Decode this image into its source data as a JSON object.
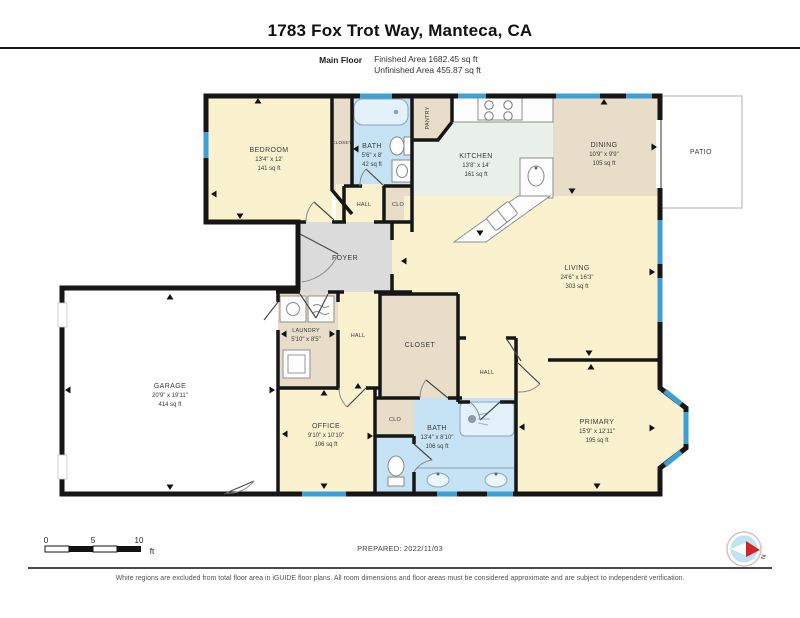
{
  "header": {
    "title": "1783 Fox Trot Way, Manteca, CA",
    "floor_label": "Main Floor",
    "finished_area": "Finished Area 1682.45 sq ft",
    "unfinished_area": "Unfinished Area 455.87 sq ft"
  },
  "rooms": {
    "bedroom": {
      "name": "BEDROOM",
      "dims": "13'4\" x 12'",
      "area": "141 sq ft"
    },
    "closet_top": {
      "name": "CLOSET"
    },
    "bath_top": {
      "name": "BATH",
      "dims": "5'6\" x 8'",
      "area": "42 sq ft"
    },
    "hall_top": {
      "name": "HALL"
    },
    "clo_top": {
      "name": "CLO"
    },
    "pantry": {
      "name": "PANTRY"
    },
    "kitchen": {
      "name": "KITCHEN",
      "dims": "13'8\" x 14'",
      "area": "161 sq ft"
    },
    "dining": {
      "name": "DINING",
      "dims": "10'9\" x 9'9\"",
      "area": "105 sq ft"
    },
    "patio": {
      "name": "PATIO"
    },
    "living": {
      "name": "LIVING",
      "dims": "24'6\" x 16'3\"",
      "area": "303 sq ft"
    },
    "foyer": {
      "name": "FOYER"
    },
    "laundry": {
      "name": "LAUNDRY",
      "dims": "5'10\" x 8'5\""
    },
    "hall_mid": {
      "name": "HALL"
    },
    "closet_mid": {
      "name": "CLOSET"
    },
    "hall_right": {
      "name": "HALL"
    },
    "garage": {
      "name": "GARAGE",
      "dims": "20'9\" x 19'11\"",
      "area": "414 sq ft"
    },
    "office": {
      "name": "OFFICE",
      "dims": "9'10\" x 10'10\"",
      "area": "106 sq ft"
    },
    "clo_bottom": {
      "name": "CLO"
    },
    "bath_bottom": {
      "name": "BATH",
      "dims": "13'4\" x 8'10\"",
      "area": "106 sq ft"
    },
    "primary": {
      "name": "PRIMARY",
      "dims": "15'9\" x 12'11\"",
      "area": "195 sq ft"
    }
  },
  "scale_bar": {
    "ticks": [
      "0",
      "5",
      "10"
    ],
    "unit": "ft"
  },
  "compass": {
    "north_label": "N"
  },
  "footer": {
    "prepared": "PREPARED: 2022/11/03",
    "disclaimer": "White regions are excluded from total floor area in iGUIDE floor plans. All room dimensions and floor areas must be considered approximate and are subject to independent verification."
  },
  "colors": {
    "cream": "#FAF1CF",
    "tan": "#E7DDC8",
    "bath_blue": "#C5E3F4",
    "kitchen_mint": "#E9F0E9",
    "foyer_gray": "#DBDBDB",
    "white": "#FFFFFF",
    "window_blue": "#3E9FD6",
    "wall": "#161616"
  }
}
